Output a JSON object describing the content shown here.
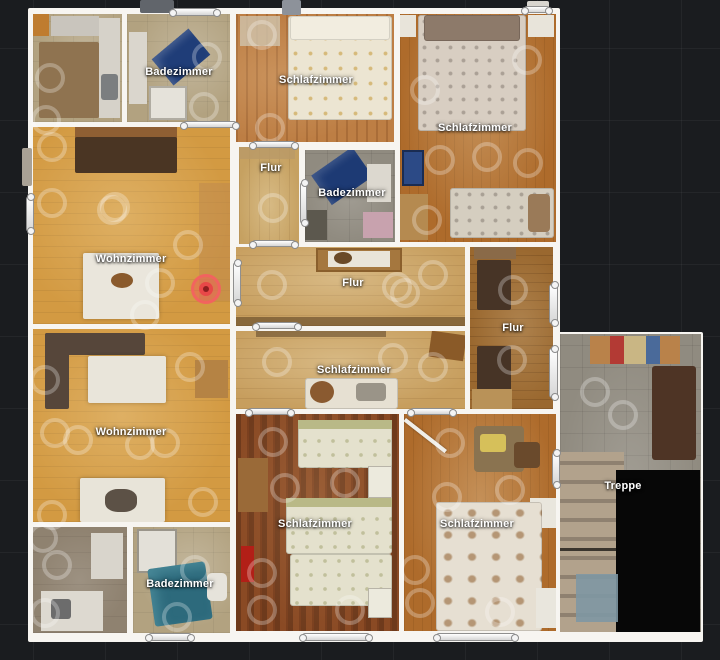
{
  "app": {
    "view": "floorplan-top-down",
    "background_color": "#1a1c1f",
    "grid_color": "rgba(255,255,255,0.045)",
    "wall_color": "#f7f5f1",
    "label_color": "#ffffff"
  },
  "floorplan": {
    "room_labels": [
      {
        "text": "Badezimmer",
        "x": 179,
        "y": 72
      },
      {
        "text": "Schlafzimmer",
        "x": 316,
        "y": 80
      },
      {
        "text": "Schlafzimmer",
        "x": 475,
        "y": 128
      },
      {
        "text": "Flur",
        "x": 271,
        "y": 168
      },
      {
        "text": "Badezimmer",
        "x": 352,
        "y": 193
      },
      {
        "text": "Wohnzimmer",
        "x": 131,
        "y": 259
      },
      {
        "text": "Flur",
        "x": 353,
        "y": 283
      },
      {
        "text": "Flur",
        "x": 513,
        "y": 328
      },
      {
        "text": "Schlafzimmer",
        "x": 354,
        "y": 370
      },
      {
        "text": "Wohnzimmer",
        "x": 131,
        "y": 432
      },
      {
        "text": "Schlafzimmer",
        "x": 315,
        "y": 524
      },
      {
        "text": "Schlafzimmer",
        "x": 477,
        "y": 524
      },
      {
        "text": "Badezimmer",
        "x": 180,
        "y": 584
      },
      {
        "text": "Treppe",
        "x": 623,
        "y": 486
      }
    ],
    "position_marker": {
      "x": 206,
      "y": 289,
      "color_outer": "#f25a5a",
      "color_inner": "#e84848",
      "color_core": "#8e1f1f"
    },
    "sweep_points": [
      [
        50,
        78
      ],
      [
        46,
        120
      ],
      [
        52,
        147
      ],
      [
        115,
        207
      ],
      [
        207,
        57
      ],
      [
        204,
        107
      ],
      [
        52,
        203
      ],
      [
        112,
        210
      ],
      [
        188,
        245
      ],
      [
        160,
        283
      ],
      [
        145,
        315
      ],
      [
        262,
        35
      ],
      [
        270,
        128
      ],
      [
        273,
        208
      ],
      [
        527,
        60
      ],
      [
        425,
        90
      ],
      [
        440,
        160
      ],
      [
        487,
        157
      ],
      [
        528,
        163
      ],
      [
        427,
        220
      ],
      [
        272,
        285
      ],
      [
        397,
        287
      ],
      [
        405,
        293
      ],
      [
        433,
        275
      ],
      [
        277,
        362
      ],
      [
        393,
        358
      ],
      [
        433,
        367
      ],
      [
        513,
        290
      ],
      [
        512,
        360
      ],
      [
        45,
        380
      ],
      [
        55,
        433
      ],
      [
        78,
        440
      ],
      [
        140,
        445
      ],
      [
        165,
        443
      ],
      [
        190,
        367
      ],
      [
        203,
        502
      ],
      [
        52,
        515
      ],
      [
        43,
        538
      ],
      [
        57,
        565
      ],
      [
        45,
        613
      ],
      [
        177,
        617
      ],
      [
        195,
        570
      ],
      [
        273,
        442
      ],
      [
        285,
        488
      ],
      [
        345,
        483
      ],
      [
        262,
        573
      ],
      [
        262,
        610
      ],
      [
        350,
        610
      ],
      [
        450,
        443
      ],
      [
        447,
        497
      ],
      [
        510,
        490
      ],
      [
        415,
        570
      ],
      [
        420,
        603
      ],
      [
        500,
        612
      ],
      [
        595,
        392
      ],
      [
        623,
        415
      ]
    ],
    "door_markers": [
      {
        "x": 172,
        "y": 8,
        "w": 46,
        "h": 8
      },
      {
        "x": 524,
        "y": 6,
        "w": 26,
        "h": 7
      },
      {
        "x": 183,
        "y": 121,
        "w": 54,
        "h": 7
      },
      {
        "x": 252,
        "y": 141,
        "w": 44,
        "h": 7
      },
      {
        "x": 252,
        "y": 240,
        "w": 44,
        "h": 7
      },
      {
        "x": 255,
        "y": 322,
        "w": 44,
        "h": 7
      },
      {
        "x": 248,
        "y": 408,
        "w": 44,
        "h": 7
      },
      {
        "x": 410,
        "y": 408,
        "w": 44,
        "h": 7
      },
      {
        "x": 148,
        "y": 633,
        "w": 44,
        "h": 8
      },
      {
        "x": 302,
        "y": 633,
        "w": 68,
        "h": 8
      },
      {
        "x": 436,
        "y": 633,
        "w": 80,
        "h": 8
      },
      {
        "x": 26,
        "y": 196,
        "w": 8,
        "h": 36
      },
      {
        "x": 233,
        "y": 262,
        "w": 8,
        "h": 42
      },
      {
        "x": 300,
        "y": 182,
        "w": 7,
        "h": 42
      },
      {
        "x": 549,
        "y": 284,
        "w": 9,
        "h": 40
      },
      {
        "x": 549,
        "y": 348,
        "w": 9,
        "h": 50
      },
      {
        "x": 552,
        "y": 452,
        "w": 8,
        "h": 34
      }
    ],
    "scan_artifacts": [
      {
        "x": 140,
        "y": 0,
        "w": 34,
        "h": 13,
        "color": "#61656b"
      },
      {
        "x": 282,
        "y": 0,
        "w": 19,
        "h": 15,
        "color": "#8d929a"
      },
      {
        "x": 527,
        "y": 1,
        "w": 22,
        "h": 9,
        "color": "#d8d5cf"
      },
      {
        "x": 22,
        "y": 148,
        "w": 10,
        "h": 38,
        "color": "#a9a195"
      }
    ]
  }
}
